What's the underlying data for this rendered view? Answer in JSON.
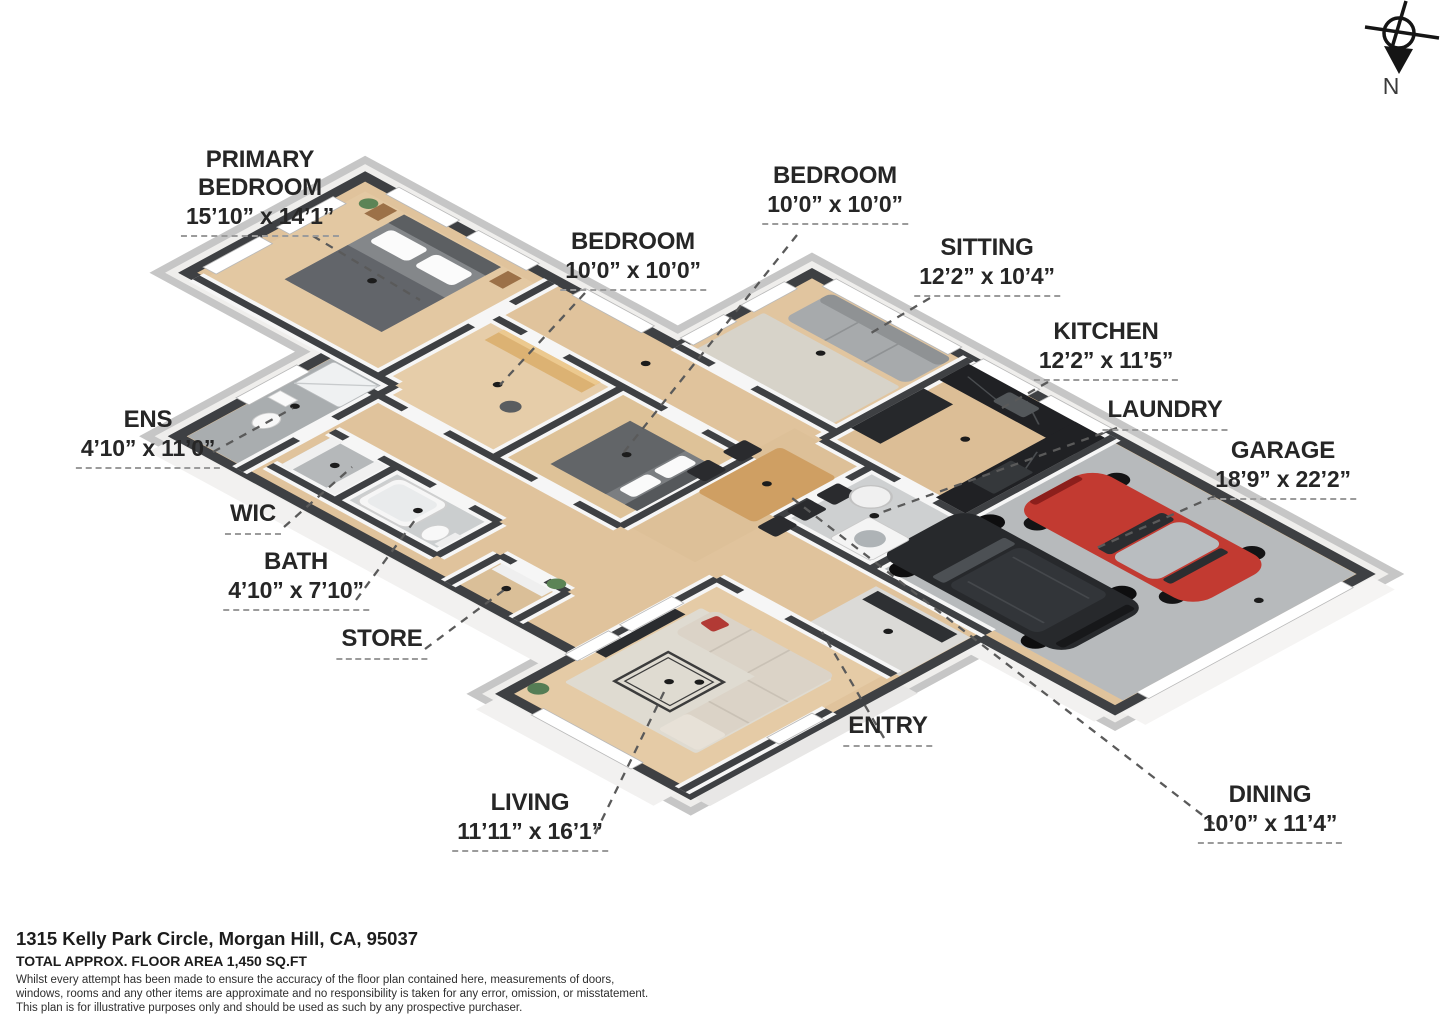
{
  "compass": {
    "north_label": "N"
  },
  "plan": {
    "labels": [
      {
        "id": "primary-bedroom",
        "lines": [
          "PRIMARY",
          "BEDROOM"
        ],
        "dims": "15’10” x 14’1”"
      },
      {
        "id": "bedroom-left",
        "lines": [
          "BEDROOM"
        ],
        "dims": "10’0” x 10’0”"
      },
      {
        "id": "bedroom-right",
        "lines": [
          "BEDROOM"
        ],
        "dims": "10’0” x 10’0”"
      },
      {
        "id": "sitting",
        "lines": [
          "SITTING"
        ],
        "dims": "12’2” x 10’4”"
      },
      {
        "id": "kitchen",
        "lines": [
          "KITCHEN"
        ],
        "dims": "12’2” x 11’5”"
      },
      {
        "id": "laundry",
        "lines": [
          "LAUNDRY"
        ],
        "dims": null
      },
      {
        "id": "garage",
        "lines": [
          "GARAGE"
        ],
        "dims": "18’9” x 22’2”"
      },
      {
        "id": "ens",
        "lines": [
          "ENS"
        ],
        "dims": "4’10” x 11’0”"
      },
      {
        "id": "wic",
        "lines": [
          "WIC"
        ],
        "dims": null
      },
      {
        "id": "bath",
        "lines": [
          "BATH"
        ],
        "dims": "4’10” x 7’10”"
      },
      {
        "id": "store",
        "lines": [
          "STORE"
        ],
        "dims": null
      },
      {
        "id": "living",
        "lines": [
          "LIVING"
        ],
        "dims": "11’11” x 16’1”"
      },
      {
        "id": "entry",
        "lines": [
          "ENTRY"
        ],
        "dims": null
      },
      {
        "id": "dining",
        "lines": [
          "DINING"
        ],
        "dims": "10’0” x 11’4”"
      }
    ]
  },
  "footer": {
    "address": "1315 Kelly Park Circle, Morgan Hill, CA, 95037",
    "area": "TOTAL APPROX. FLOOR AREA 1,450 SQ.FT",
    "disclaimer": [
      "Whilst every attempt has been made to ensure the accuracy of the floor plan contained here, measurements of doors,",
      "windows, rooms and any other items are approximate and no responsibility is taken for any error, omission, or misstatement.",
      "This plan is for illustrative purposes only and should be used as such by any prospective purchaser."
    ]
  },
  "colors": {
    "wood": "#e0c39c",
    "wall_top": "#3e4043",
    "slab": "#c2c2c2",
    "garage_floor": "#b7babc",
    "car_red": "#c23a31",
    "car_black": "#27292c"
  }
}
